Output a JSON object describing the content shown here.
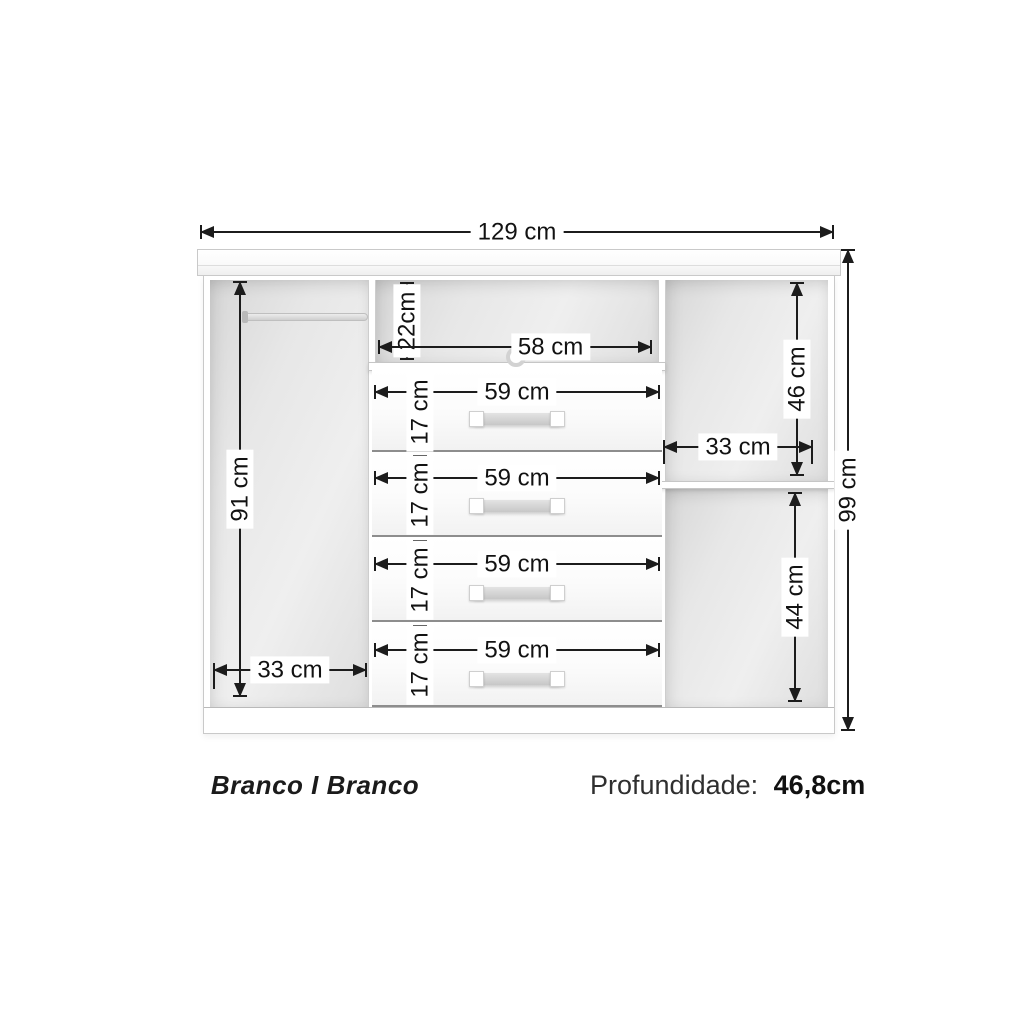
{
  "colors": {
    "line": "#1c1c1c",
    "cabinet_edge": "#c9c9c9",
    "interior_gray": "#e3e3e3"
  },
  "dimensions": {
    "overall_width": "129 cm",
    "overall_height": "99 cm",
    "left_height": "91 cm",
    "left_width": "33 cm",
    "niche_height": "22cm",
    "niche_width": "58 cm",
    "right_top_height": "46 cm",
    "right_width": "33 cm",
    "right_bottom_height": "44 cm",
    "drawers": [
      {
        "width": "59 cm",
        "height": "17 cm"
      },
      {
        "width": "59 cm",
        "height": "17 cm"
      },
      {
        "width": "59 cm",
        "height": "17 cm"
      },
      {
        "width": "59 cm",
        "height": "17 cm"
      }
    ]
  },
  "footer": {
    "color_name": "Branco I Branco",
    "depth_label": "Profundidade:",
    "depth_value": "46,8cm"
  }
}
